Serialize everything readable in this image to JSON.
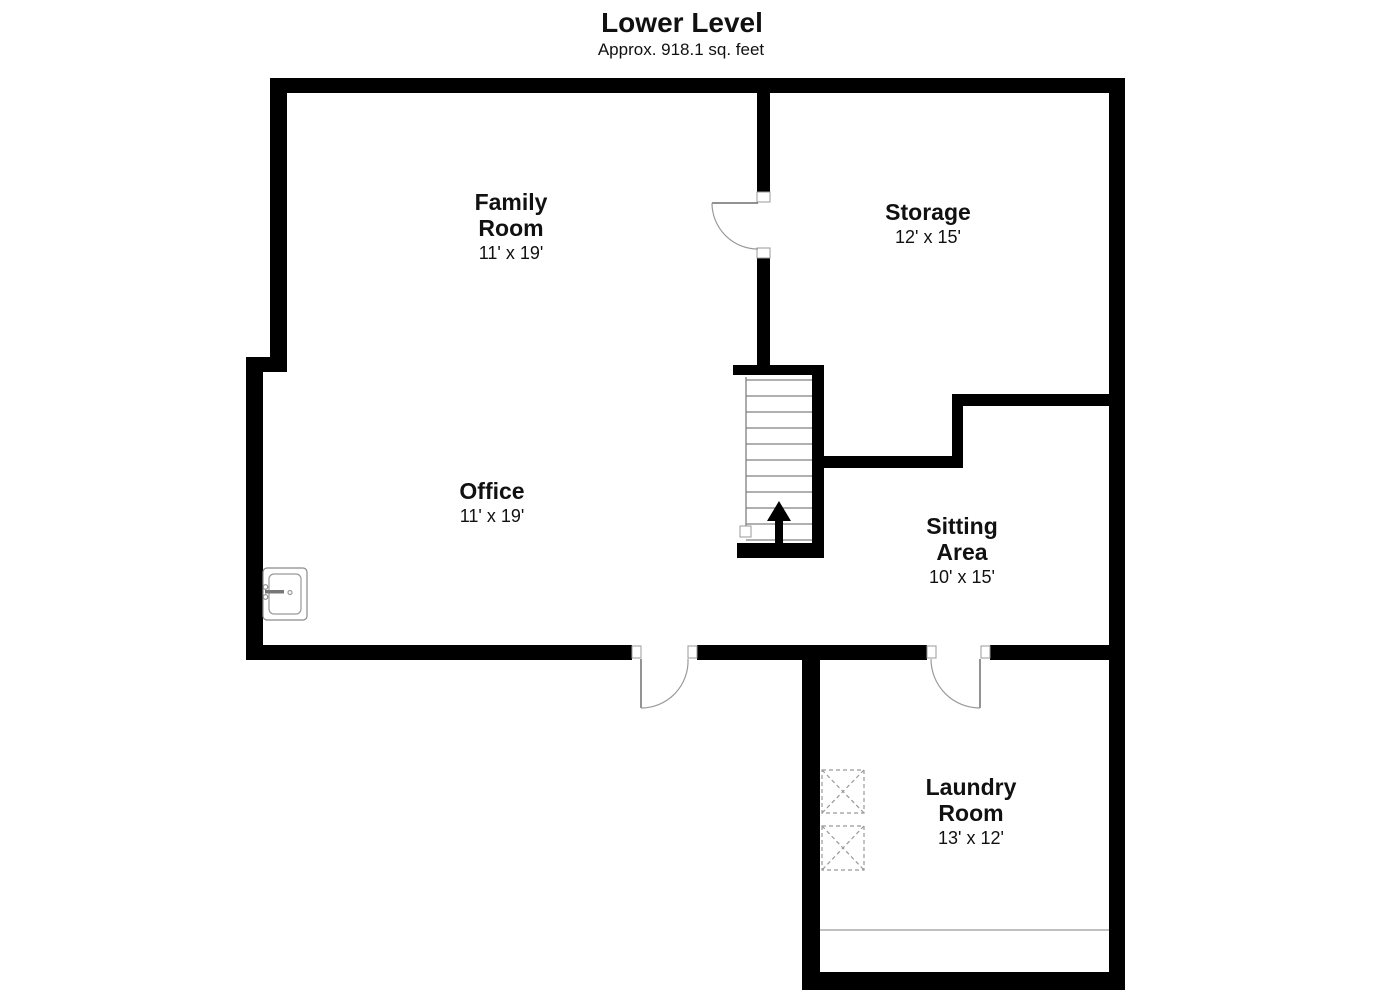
{
  "header": {
    "title": "Lower Level",
    "subtitle": "Approx. 918.1 sq. feet"
  },
  "rooms": {
    "family": {
      "line1": "Family",
      "line2": "Room",
      "dims": "11' x 19'"
    },
    "storage": {
      "line1": "Storage",
      "dims": "12' x 15'"
    },
    "office": {
      "line1": "Office",
      "dims": "11' x 19'"
    },
    "sitting": {
      "line1": "Sitting",
      "line2": "Area",
      "dims": "10' x 15'"
    },
    "laundry": {
      "line1": "Laundry",
      "line2": "Room",
      "dims": "13' x 12'"
    }
  },
  "fixtures": {
    "stairs": {
      "direction": "up",
      "tread_count": 11,
      "icon": "up-arrow-icon"
    },
    "sink": "utility-sink",
    "laundry_appliances": [
      "washer",
      "dryer"
    ],
    "doors": [
      "family-storage-door",
      "office-lower-door",
      "laundry-door"
    ]
  },
  "colors": {
    "wall": "#000000",
    "thin_line": "#808080",
    "dashed": "#999999",
    "text": "#111111",
    "background": "#ffffff"
  }
}
